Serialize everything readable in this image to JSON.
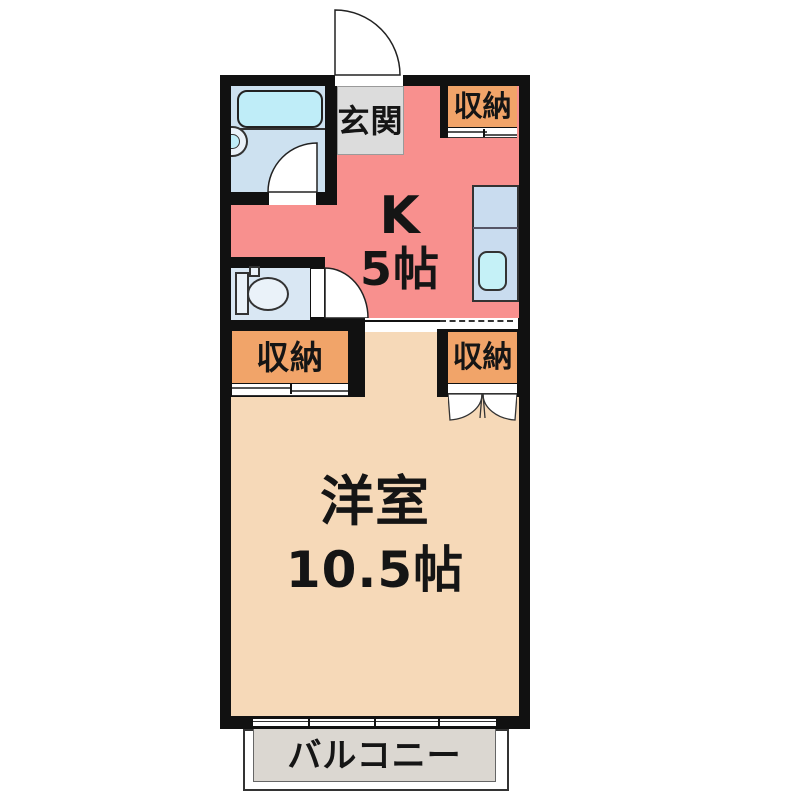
{
  "floorplan": {
    "genkan": {
      "label": "玄関"
    },
    "kitchen": {
      "name": "K",
      "size": "5帖"
    },
    "closet_top_right": {
      "label": "収納"
    },
    "closet_bottom_left": {
      "label": "収納"
    },
    "closet_bottom_right": {
      "label": "収納"
    },
    "western_room": {
      "name": "洋室",
      "size": "10.5帖"
    },
    "balcony": {
      "label": "バルコニー"
    },
    "colors": {
      "wall": "#111111",
      "kitchen_floor": "#F8908E",
      "western_room_floor": "#F6D9B8",
      "closet_fill": "#F1A469",
      "genkan_floor": "#DCDCDC",
      "bathroom_floor": "#CDE1F0",
      "bathtub": "#BFEDF8",
      "toilet_floor": "#D9E7F3",
      "kitchen_counter": "#C9DCEF",
      "sink": "#C5F1F7",
      "balcony_floor": "#DBD7D1"
    }
  }
}
